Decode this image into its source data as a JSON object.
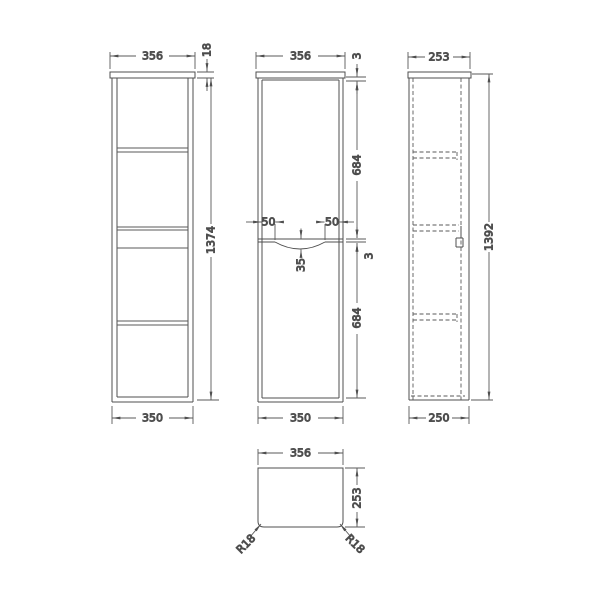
{
  "colors": {
    "background": "#ffffff",
    "line": "#4f4f4f",
    "text": "#2f2f2f"
  },
  "views": {
    "front_open": {
      "dims": {
        "width_top": "356",
        "top_panel_thickness": "18",
        "carcass_height": "1374",
        "width_bottom": "350"
      }
    },
    "front_doors": {
      "dims": {
        "width_top": "356",
        "top_gap": "3",
        "upper_door_height": "684",
        "handle_inset_left": "50",
        "handle_inset_right": "50",
        "handle_recess_depth": "35",
        "door_gap": "3",
        "lower_door_height": "684",
        "width_bottom": "350"
      }
    },
    "side": {
      "dims": {
        "depth_top": "253",
        "overall_height": "1392",
        "depth_bottom": "250"
      }
    },
    "plan": {
      "dims": {
        "width": "356",
        "depth": "253",
        "corner_radius_left": "R18",
        "corner_radius_right": "R18"
      }
    }
  }
}
